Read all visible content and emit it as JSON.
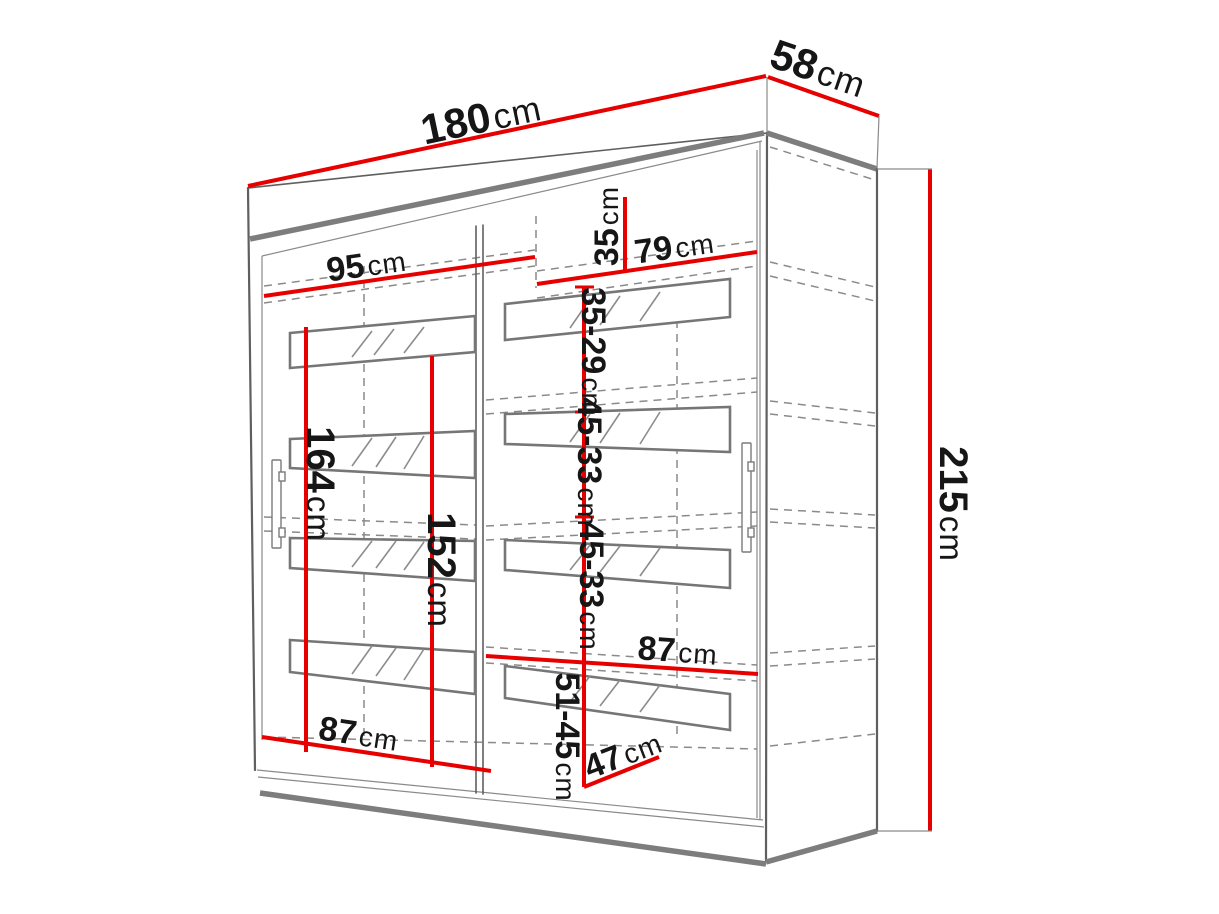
{
  "dimensions": {
    "width": {
      "value": "180",
      "unit": "cm"
    },
    "depth": {
      "value": "58",
      "unit": "cm"
    },
    "height": {
      "value": "215",
      "unit": "cm"
    },
    "top_left_section_width": {
      "value": "95",
      "unit": "cm"
    },
    "top_right_section_width": {
      "value": "79",
      "unit": "cm"
    },
    "top_shelf_height": {
      "value": "35",
      "unit": "cm"
    },
    "right_shelf_gap_1": {
      "value": "35-29",
      "unit": "cm"
    },
    "right_shelf_gap_2": {
      "value": "45-33",
      "unit": "cm"
    },
    "right_shelf_gap_3": {
      "value": "45-33",
      "unit": "cm"
    },
    "right_shelf_gap_4": {
      "value": "51-45",
      "unit": "cm"
    },
    "left_hanging_height": {
      "value": "164",
      "unit": "cm"
    },
    "center_hanging_height": {
      "value": "152",
      "unit": "cm"
    },
    "bottom_left_section_width": {
      "value": "87",
      "unit": "cm"
    },
    "bottom_right_section_width": {
      "value": "87",
      "unit": "cm"
    },
    "interior_depth": {
      "value": "47",
      "unit": "cm"
    }
  },
  "colors": {
    "dimension_line": "#e60000",
    "outline": "#5f5f5f",
    "outline_strong": "#7d7d7d",
    "hidden_line": "#8a8a8a",
    "text": "#161616",
    "background": "#ffffff"
  }
}
